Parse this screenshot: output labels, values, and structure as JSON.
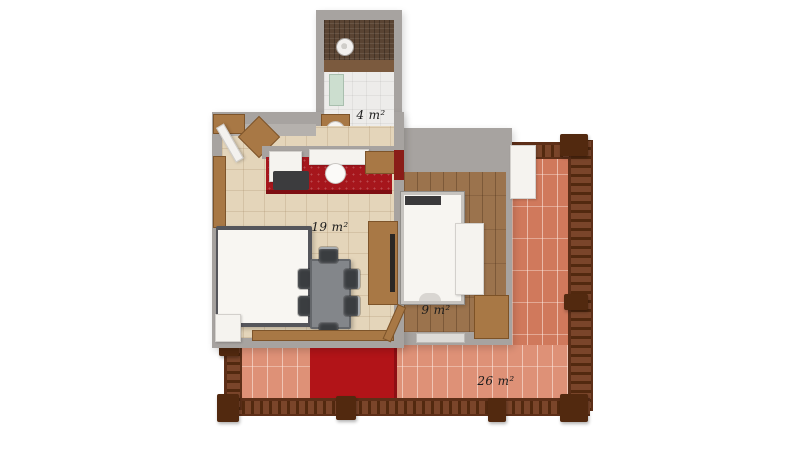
{
  "plan": {
    "rooms": {
      "bathroom": {
        "area_label": "4 m²"
      },
      "living_room": {
        "area_label": "19 m²"
      },
      "bedroom": {
        "area_label": "9 m²"
      },
      "terrace": {
        "area_label": "26 m²"
      }
    }
  },
  "colors": {
    "wall_gray": "#a7a3a0",
    "living_floor": "#e4d5ba",
    "bedroom_floor": "#9b734d",
    "terrace_tile": "#d0795c",
    "terrace_tile_light": "#de9177",
    "railing_brown": "#52290f",
    "railing_base": "#7a452a",
    "kitchen_red": "#a6161c",
    "rug_red": "#b21418",
    "accent_dark_red": "#8a1d18",
    "furniture_white": "#f5f3ef",
    "wood_brown": "#a87845",
    "table_gray": "#83868a",
    "chair_dark": "#3a3d40",
    "shower_dark": "#5a4433",
    "label_text": "#1c1c1c"
  }
}
